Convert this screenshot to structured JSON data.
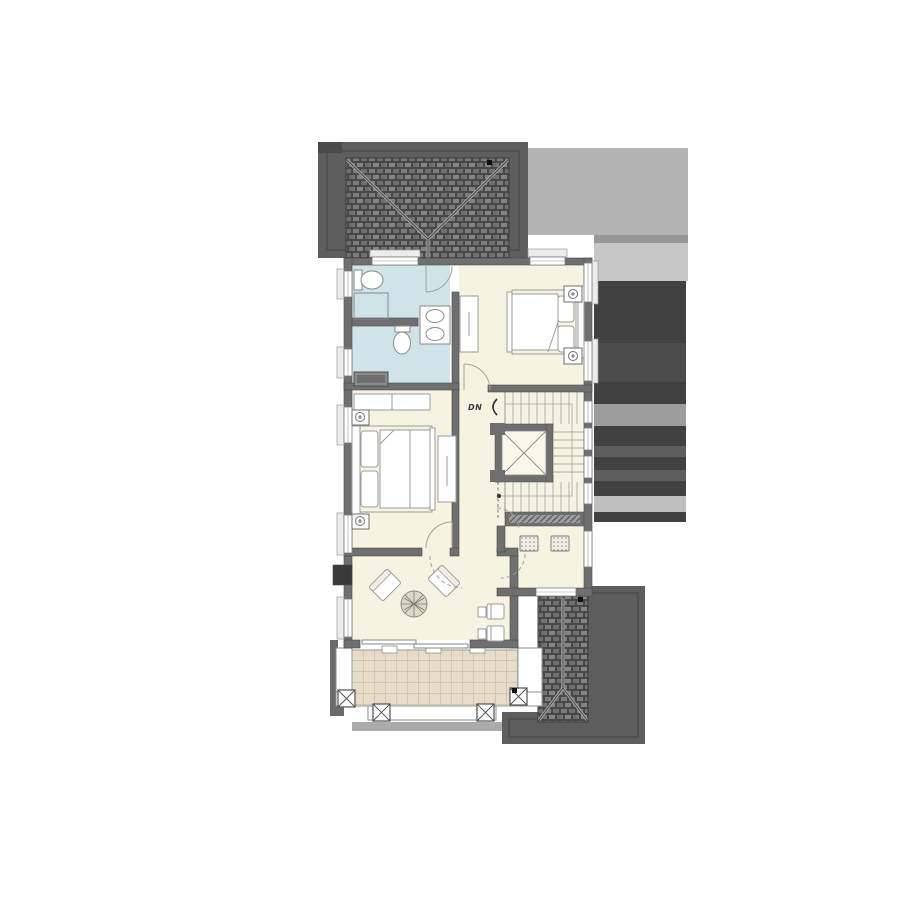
{
  "plan": {
    "title": "second-floor-plan",
    "stairs": {
      "dn_label": "DN"
    },
    "palette": {
      "background": "#ffffff",
      "roof_shadow_dark": "#5e5e5e",
      "roof_tile_line": "#3f3f3f",
      "shadow_light": "#b3b3b3",
      "shadow_band": "#979797",
      "shadow_lighter": "#c6c6c6",
      "shadow_deep": "#414141",
      "shadow_glow": "#9d9d9d",
      "shadow_bright": "#bfbfbf",
      "wall": "#6f6f6f",
      "wall_edge": "#4a4a4a",
      "floor_cream": "#f7f3e2",
      "floor_bath": "#cfe3e8",
      "terrace_tile": "#e6dcc9",
      "terrace_grid": "#c3b193",
      "furniture_line": "#9b9b9b",
      "window_fill": "#ffffff",
      "shaft_fill": "#faf7ea"
    }
  }
}
